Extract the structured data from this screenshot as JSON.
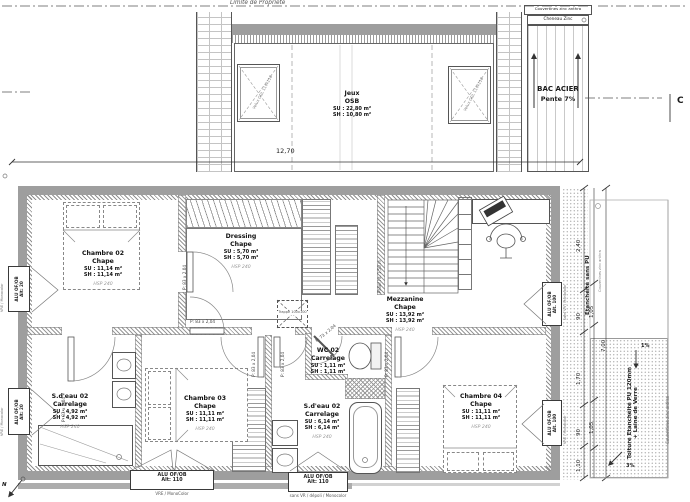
{
  "drawing": {
    "property_line": "Limite de Propriété",
    "section_mark": "C",
    "north_mark": "N"
  },
  "roof": {
    "room": {
      "name": "Jeux",
      "finish": "OSB",
      "su": "SU : 22,80 m²",
      "sh": "SH : 10,80 m²"
    },
    "velux_left": "Velux GGL 114x118",
    "velux_right": "Velux GGL 114x118",
    "strip_header": "Couvertines zinc anthra",
    "strip_subheader": "Cheneau Zinc",
    "bac_acier_line1": "BAC ACIER",
    "bac_acier_line2": "Pente 7%"
  },
  "rooms": {
    "chambre02": {
      "name": "Chambre 02",
      "finish": "Chape",
      "su": "SU : 11,14 m²",
      "sh": "SH : 11,14 m²",
      "hsp": "HSP 240"
    },
    "dressing": {
      "name": "Dressing",
      "finish": "Chape",
      "su": "SU : 5,70 m²",
      "sh": "SH : 5,70 m²",
      "hsp": "HSP 240"
    },
    "mezzanine": {
      "name": "Mezzanine",
      "finish": "Chape",
      "su": "SU : 13,92 m²",
      "sh": "SH : 13,92 m²",
      "hsp": "HSP 240"
    },
    "sdeau02_left": {
      "name": "S.d'eau 02",
      "finish": "Carrelage",
      "su": "SU : 4,92 m²",
      "sh": "SH : 4,92 m²",
      "hsp": "HSP 240"
    },
    "chambre03": {
      "name": "Chambre 03",
      "finish": "Chape",
      "su": "SU : 11,11 m²",
      "sh": "SH : 11,11 m²",
      "hsp": "HSP 240"
    },
    "wc02": {
      "name": "WC 02",
      "finish": "Carrelage",
      "su": "SU : 1,11 m²",
      "sh": "SH : 1,11 m²"
    },
    "sdeau02_mid": {
      "name": "S.d'eau 02",
      "finish": "Carrelage",
      "su": "SU : 6,14 m²",
      "sh": "SH : 6,14 m²",
      "hsp": "HSP 240"
    },
    "chambre04": {
      "name": "Chambre 04",
      "finish": "Chape",
      "su": "SU : 11,11 m²",
      "sh": "SH : 11,11 m²",
      "hsp": "HSP 240"
    }
  },
  "doors": {
    "standard": "P: 83 x 2,04",
    "narrow": "P: 73 x 2,04"
  },
  "windows": {
    "left": {
      "label": "ALU OF/OB",
      "alt": "Alt: 20",
      "sub": "VRE / Monocolor"
    },
    "bottom_left": {
      "label": "ALU OF/OB",
      "alt": "Alt: 110",
      "sub": "VRE / MonoColor"
    },
    "bottom_mid": {
      "label": "ALU OF/OB",
      "alt": "Alt: 110",
      "sub": "sans VR / dépoli / Monocolor"
    },
    "right_upper": {
      "label": "ALU OF/OB",
      "alt": "Alt. 100",
      "sub": "sans VR / Monocolor"
    },
    "right_lower": {
      "label": "ALU OF/OB",
      "alt": "Alt. 100",
      "sub": "VRE / Monocolor"
    }
  },
  "annotations": {
    "etancheite": "Etanchéité sans PU",
    "toiture_line1": "Toiture Etanchéité PU 120mm",
    "toiture_line2": "+ Laine de Verre",
    "slope_top": "1%",
    "slope_bottom": "3%",
    "couvertines_small": "Couvertines zinc anthra",
    "couvertines_right": "Couvertines zinc anthra",
    "palier": "Palier ht. 1,50 m",
    "trappe": "Trappe 100x100"
  },
  "dimensions": {
    "overall_width": "12,70",
    "overall_height": "7,00",
    "d240": "2,40",
    "d90a": "90",
    "d105a": "1,05",
    "d170": "1,70",
    "d90b": "90",
    "d105b": "1,05",
    "d110": "1,10"
  }
}
